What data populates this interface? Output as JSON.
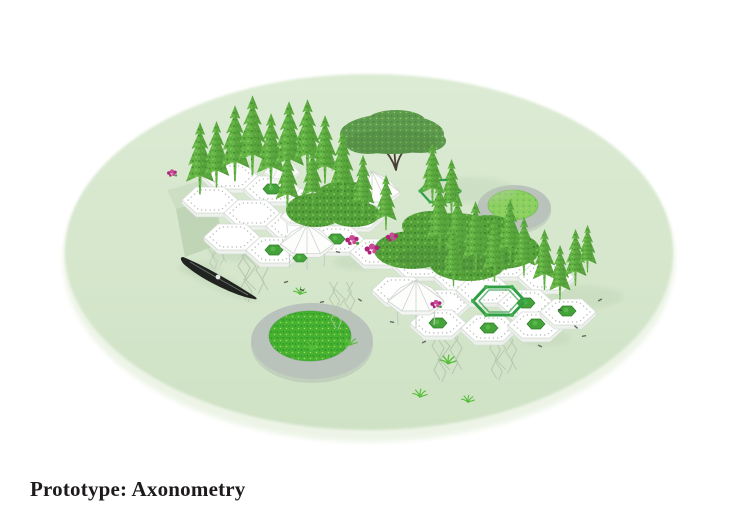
{
  "caption": {
    "text": "Prototype: Axonometry"
  },
  "figure": {
    "type": "axonometric-architectural-rendering",
    "parts": [
      "circular ground plane",
      "hexagonal module platforms with dotted edges",
      "white faceted dome pavilions",
      "conifer trees",
      "broad canopy tree",
      "vine canopies with pink flowers",
      "green hexagonal pergola frames",
      "black gondola boat",
      "two circular grass pads",
      "hanging root lattices under modules",
      "scattered grass tufts and debris"
    ]
  },
  "colors": {
    "pageBg": "#ffffff",
    "groundTop": "#dcebd4",
    "groundBottom": "#cfe2c5",
    "groundEdge": "#edf4e7",
    "platform": "#ffffff",
    "platformSide": "#edf1ec",
    "platformLine": "#d4dad3",
    "dotLine": "#b9bfb8",
    "treeGreen": "#64b545",
    "treeGreenDark": "#468e30",
    "treeGreenLight": "#8ccc61",
    "bushGreen": "#55a23b",
    "bushGreenDark": "#3c7f28",
    "canopyGreen": "#5e9a4e",
    "canopyGreenDark": "#4c8340",
    "planterGreen": "#43a339",
    "planterGreenDark": "#2e7d2a",
    "padRing": "#b9c3bc",
    "padGrass": "#45b231",
    "padGrassDark": "#2f9224",
    "padGrassLime": "#a8d84e",
    "padGrassLight": "#8ccf63",
    "flowerPink": "#ad2478",
    "flowerPinkLight": "#c94b96",
    "frameGreen": "#2f9e45",
    "boatBlack": "#20231f",
    "rootGray": "#b4c4ae",
    "shadowGreen": "#b9cfae",
    "rampGreen": "#ccdfc3",
    "rampGreenDark": "#c0d5b6",
    "trunkBrown": "#4a3f35",
    "debris": "#3f423e",
    "captionText": "#1d1a1b"
  }
}
